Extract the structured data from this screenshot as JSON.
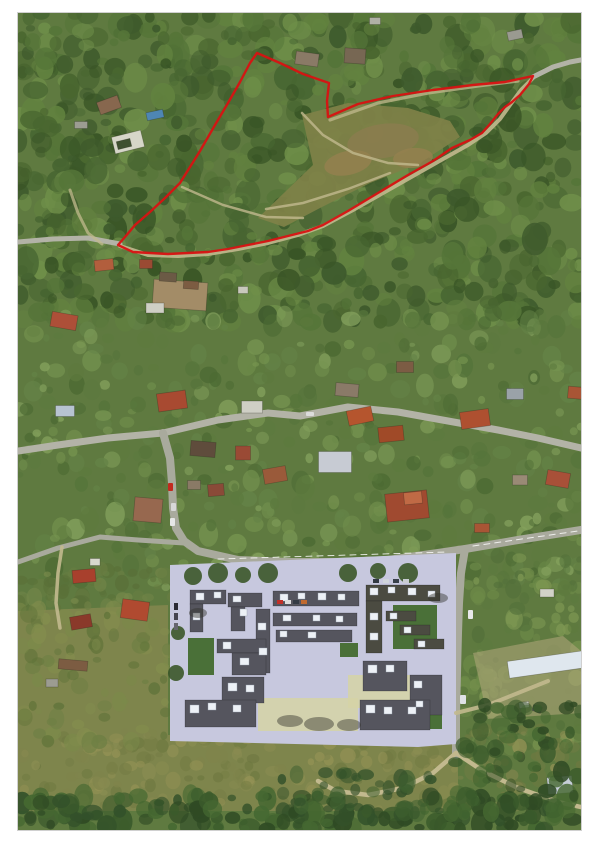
{
  "scene": "aerial-orthophoto-with-parcel-outline",
  "photo": {
    "left": 18,
    "top": 13,
    "width": 563,
    "height": 817
  },
  "colors": {
    "page_bg": "#ffffff",
    "base_green": "#5f7a40",
    "parcel_outline": "#d81212",
    "meadow": "#7f8148",
    "meadow_brown": "#8b7c4f",
    "meadow_brown2": "#94804f",
    "field": "#7e854c",
    "dev_ground": "#c7c8de",
    "dev_building": "#55555e",
    "dev_building_green_roof": "#4b4b41",
    "roofbox": "#edf1f6",
    "lawn": "#4a7038",
    "pale_court": "#d5d3a6",
    "dirt": "#b3a87c",
    "road_main": "#b3b3a7",
    "road_dev": "#a9aa9d",
    "path_tan": "#c2b98e"
  },
  "parcel": {
    "stroke_width": 2.4,
    "points": [
      [
        239,
        40
      ],
      [
        262,
        50
      ],
      [
        285,
        61
      ],
      [
        311,
        70
      ],
      [
        309,
        88
      ],
      [
        310,
        104
      ],
      [
        340,
        91
      ],
      [
        375,
        83
      ],
      [
        415,
        77
      ],
      [
        455,
        72
      ],
      [
        487,
        69
      ],
      [
        515,
        63
      ],
      [
        511,
        71
      ],
      [
        502,
        82
      ],
      [
        494,
        89
      ],
      [
        487,
        94
      ],
      [
        480,
        101
      ],
      [
        472,
        111
      ],
      [
        464,
        120
      ],
      [
        452,
        127
      ],
      [
        434,
        135
      ],
      [
        415,
        148
      ],
      [
        390,
        162
      ],
      [
        360,
        180
      ],
      [
        330,
        198
      ],
      [
        305,
        212
      ],
      [
        290,
        218
      ],
      [
        270,
        223
      ],
      [
        250,
        228
      ],
      [
        230,
        232
      ],
      [
        210,
        236
      ],
      [
        190,
        239
      ],
      [
        170,
        240
      ],
      [
        150,
        241
      ],
      [
        132,
        240
      ],
      [
        115,
        239
      ],
      [
        100,
        232
      ],
      [
        107,
        224
      ],
      [
        117,
        212
      ],
      [
        132,
        199
      ],
      [
        147,
        185
      ],
      [
        162,
        170
      ],
      [
        182,
        138
      ],
      [
        197,
        112
      ],
      [
        210,
        90
      ],
      [
        222,
        69
      ],
      [
        232,
        50
      ]
    ]
  },
  "meadow": {
    "poly": [
      [
        240,
        205
      ],
      [
        268,
        178
      ],
      [
        295,
        152
      ],
      [
        284,
        102
      ],
      [
        330,
        90
      ],
      [
        390,
        95
      ],
      [
        432,
        108
      ],
      [
        442,
        124
      ],
      [
        402,
        150
      ],
      [
        352,
        170
      ],
      [
        302,
        195
      ],
      [
        266,
        214
      ]
    ],
    "brown_spots": [
      [
        365,
        128,
        36,
        17,
        -8
      ],
      [
        330,
        150,
        24,
        12,
        -12
      ],
      [
        395,
        145,
        20,
        10,
        -5
      ]
    ],
    "paths": [
      "M284,100 L305,122 L335,140 L370,150 L400,152",
      "M248,196 L285,190 L330,176 L372,160",
      "M164,174 L205,192 L248,204 L285,205"
    ]
  },
  "fields": [
    [
      [
        0,
        598
      ],
      [
        150,
        592
      ],
      [
        150,
        722
      ],
      [
        440,
        722
      ],
      [
        440,
        798
      ],
      [
        0,
        798
      ]
    ]
  ],
  "dirt_patches": [
    [
      [
        455,
        640
      ],
      [
        545,
        623
      ],
      [
        563,
        638
      ],
      [
        563,
        700
      ],
      [
        470,
        706
      ]
    ]
  ],
  "roads": [
    {
      "d": "M0,438 L40,432 L90,425 L145,420 L200,407 L250,400 L282,403 L330,394 L380,399 L430,408 L480,417 L520,425 L563,435",
      "c": "road_main",
      "w": 7
    },
    {
      "d": "M0,229 L35,226 L70,225 L102,231",
      "c": "road_main",
      "w": 5
    },
    {
      "d": "M145,420 L152,445 L154,470 L155,495 L158,515 L166,528 L180,538 L220,547 L270,549 L320,549 L370,547 L420,540 L447,536 L500,527 L563,517",
      "c": "road_dev",
      "w": 8
    },
    {
      "d": "M447,536 L443,560 L441,590 L440,620 L439,660 L438,700 L438,742",
      "c": "road_dev",
      "w": 8
    },
    {
      "d": "M166,530 L120,527 L82,524 L40,535 L0,549",
      "c": "road_dev",
      "w": 5
    },
    {
      "d": "M44,534 L40,560 L38,590 L42,615",
      "c": "path_tan",
      "w": 3.5,
      "o": 0.9
    },
    {
      "d": "M52,177 L60,200 L70,220 L84,231",
      "c": "path_tan",
      "w": 3,
      "o": 0.75
    },
    {
      "d": "M102,233 L130,242 L160,243 L190,241 L220,236 L250,230 L280,222 L305,213 L335,197 L365,180 L395,163 L425,146 L450,132 L468,120 L482,106 L492,92 L503,77 L515,65",
      "c": "path_tan",
      "w": 4,
      "o": 0.9
    },
    {
      "d": "M312,107 L360,90 L410,80 L460,73 L500,68",
      "c": "path_tan",
      "w": 3.2,
      "o": 0.75
    },
    {
      "d": "M515,64 L535,54 L552,49 L563,47",
      "c": "road_main",
      "w": 5
    },
    {
      "d": "M200,546 L430,539",
      "c": "#ffffff",
      "w": 1,
      "o": 0.8,
      "dash": "6,5"
    },
    {
      "d": "M455,533 L560,518",
      "c": "#ffffff",
      "w": 1,
      "o": 0.8,
      "dash": "6,5"
    }
  ],
  "bottom_paths": [
    {
      "d": "M438,740 L465,758 L500,775 L540,789 L563,794",
      "c": "path_tan",
      "w": 4.5
    },
    {
      "d": "M438,740 L415,760 L385,775 L350,782 L318,778 L300,768",
      "c": "path_tan",
      "w": 4.5
    },
    {
      "d": "M438,700 L470,692 L505,678 L530,668",
      "c": "path_tan",
      "w": 4,
      "o": 0.9
    }
  ],
  "houses": [
    [
      91,
      92,
      22,
      13,
      -20,
      "#87674e"
    ],
    [
      137,
      102,
      17,
      8,
      -12,
      "#4e86b4"
    ],
    [
      110,
      129,
      30,
      17,
      -14,
      "#d6d6c8"
    ],
    [
      106,
      131,
      14,
      8,
      -14,
      "#3f5030"
    ],
    [
      63,
      112,
      13,
      7,
      0,
      "#9c9c92"
    ],
    [
      289,
      46,
      23,
      13,
      8,
      "#8a7a66"
    ],
    [
      337,
      43,
      21,
      15,
      4,
      "#776753"
    ],
    [
      357,
      8,
      11,
      7,
      0,
      "#b0b0a6"
    ],
    [
      497,
      22,
      15,
      9,
      -12,
      "#9a9a90"
    ],
    [
      46,
      308,
      26,
      15,
      10,
      "#ad4f38"
    ],
    [
      86,
      252,
      19,
      11,
      -6,
      "#b25e3d"
    ],
    [
      128,
      251,
      13,
      9,
      0,
      "#9a4a33"
    ],
    [
      162,
      282,
      54,
      28,
      4,
      "#a38c67"
    ],
    [
      150,
      264,
      17,
      9,
      4,
      "#6b5a45"
    ],
    [
      173,
      272,
      15,
      8,
      4,
      "#7c5c42"
    ],
    [
      225,
      277,
      10,
      7,
      0,
      "#c8c8bc"
    ],
    [
      137,
      295,
      18,
      10,
      0,
      "#cfcfc5"
    ],
    [
      47,
      398,
      19,
      11,
      0,
      "#b7c3d1"
    ],
    [
      154,
      388,
      29,
      18,
      -8,
      "#a84a31"
    ],
    [
      234,
      394,
      21,
      12,
      0,
      "#cfcfc5"
    ],
    [
      342,
      403,
      25,
      15,
      -12,
      "#b5552e"
    ],
    [
      373,
      421,
      25,
      15,
      -6,
      "#a04a28"
    ],
    [
      457,
      406,
      29,
      17,
      -8,
      "#ae5030"
    ],
    [
      329,
      377,
      23,
      13,
      5,
      "#8a7a68"
    ],
    [
      387,
      354,
      17,
      11,
      0,
      "#7c5c44"
    ],
    [
      560,
      380,
      20,
      12,
      5,
      "#a85535"
    ],
    [
      497,
      381,
      17,
      11,
      0,
      "#9aa2a8"
    ],
    [
      185,
      436,
      25,
      15,
      5,
      "#5f4c3c"
    ],
    [
      225,
      440,
      15,
      14,
      0,
      "#9a4a35"
    ],
    [
      198,
      477,
      16,
      12,
      -5,
      "#8a4a38"
    ],
    [
      130,
      497,
      28,
      24,
      5,
      "#97684f"
    ],
    [
      257,
      462,
      23,
      15,
      -10,
      "#9a5a3a"
    ],
    [
      317,
      449,
      33,
      21,
      0,
      "#c7cbd3"
    ],
    [
      389,
      493,
      42,
      28,
      -6,
      "#a04a30"
    ],
    [
      395,
      485,
      18,
      12,
      -6,
      "#c06a45"
    ],
    [
      540,
      466,
      23,
      15,
      10,
      "#a85038"
    ],
    [
      176,
      472,
      13,
      9,
      0,
      "#8a7a66"
    ],
    [
      502,
      467,
      15,
      10,
      0,
      "#9a8a76"
    ],
    [
      464,
      515,
      15,
      9,
      0,
      "#a85535"
    ],
    [
      77,
      549,
      10,
      7,
      0,
      "#d8d8ce"
    ],
    [
      66,
      563,
      23,
      13,
      -5,
      "#a8402d"
    ],
    [
      117,
      597,
      27,
      19,
      8,
      "#b04a30"
    ],
    [
      63,
      609,
      21,
      13,
      -10,
      "#8a392a"
    ],
    [
      55,
      652,
      29,
      10,
      5,
      "#7c5c42"
    ],
    [
      34,
      670,
      12,
      8,
      0,
      "#9c9c92"
    ],
    [
      532,
      651,
      84,
      17,
      -8,
      "#dfe7ee"
    ],
    [
      529,
      580,
      14,
      8,
      0,
      "#d2d2c8"
    ],
    [
      542,
      772,
      25,
      17,
      -5,
      "#c6ced8"
    ],
    [
      506,
      692,
      10,
      6,
      -8,
      "#e0e0d8"
    ],
    [
      519,
      696,
      9,
      6,
      20,
      "#55555c"
    ]
  ],
  "development": {
    "ground": [
      [
        152,
        552
      ],
      [
        438,
        540
      ],
      [
        438,
        731
      ],
      [
        400,
        734
      ],
      [
        152,
        728
      ]
    ],
    "pale": [
      [
        240,
        685,
        100,
        33
      ],
      [
        330,
        662,
        72,
        33
      ]
    ],
    "lawns": [
      [
        170,
        625,
        26,
        37
      ],
      [
        375,
        592,
        44,
        44
      ],
      [
        398,
        702,
        26,
        14
      ],
      [
        322,
        630,
        18,
        14
      ]
    ],
    "buildings": [
      [
        172,
        577,
        36,
        14
      ],
      [
        172,
        591,
        13,
        28
      ],
      [
        210,
        580,
        34,
        14
      ],
      [
        213,
        594,
        14,
        24
      ],
      [
        255,
        578,
        86,
        15
      ],
      [
        255,
        600,
        84,
        13
      ],
      [
        258,
        617,
        76,
        12
      ],
      [
        238,
        596,
        14,
        64
      ],
      [
        199,
        626,
        49,
        14
      ],
      [
        214,
        640,
        34,
        22
      ],
      [
        204,
        664,
        42,
        26
      ],
      [
        167,
        687,
        71,
        27
      ],
      [
        348,
        572,
        74,
        16,
        "g"
      ],
      [
        348,
        588,
        16,
        52,
        "g"
      ],
      [
        368,
        598,
        30,
        10,
        "g"
      ],
      [
        382,
        612,
        30,
        10,
        "g"
      ],
      [
        396,
        626,
        30,
        10,
        "g"
      ],
      [
        345,
        648,
        44,
        30
      ],
      [
        392,
        662,
        32,
        40
      ],
      [
        342,
        687,
        70,
        30
      ]
    ],
    "roofboxes": [
      [
        178,
        580,
        8,
        7
      ],
      [
        196,
        579,
        7,
        6
      ],
      [
        175,
        600,
        7,
        7
      ],
      [
        215,
        583,
        8,
        6
      ],
      [
        222,
        596,
        7,
        7
      ],
      [
        262,
        581,
        8,
        7
      ],
      [
        280,
        580,
        7,
        6
      ],
      [
        300,
        580,
        8,
        7
      ],
      [
        320,
        581,
        7,
        6
      ],
      [
        265,
        602,
        8,
        6
      ],
      [
        295,
        602,
        7,
        6
      ],
      [
        318,
        603,
        7,
        6
      ],
      [
        262,
        618,
        7,
        6
      ],
      [
        290,
        619,
        8,
        6
      ],
      [
        240,
        610,
        8,
        7
      ],
      [
        241,
        635,
        8,
        7
      ],
      [
        205,
        629,
        8,
        7
      ],
      [
        222,
        645,
        9,
        7
      ],
      [
        210,
        670,
        9,
        8
      ],
      [
        228,
        672,
        8,
        7
      ],
      [
        172,
        692,
        9,
        8
      ],
      [
        190,
        690,
        8,
        7
      ],
      [
        215,
        692,
        8,
        7
      ],
      [
        352,
        575,
        8,
        7
      ],
      [
        370,
        574,
        7,
        6
      ],
      [
        390,
        575,
        8,
        7
      ],
      [
        410,
        578,
        7,
        6
      ],
      [
        352,
        600,
        8,
        7
      ],
      [
        352,
        620,
        8,
        7
      ],
      [
        372,
        600,
        7,
        6
      ],
      [
        386,
        614,
        7,
        6
      ],
      [
        400,
        628,
        7,
        6
      ],
      [
        350,
        652,
        9,
        8
      ],
      [
        368,
        652,
        8,
        7
      ],
      [
        396,
        668,
        8,
        7
      ],
      [
        398,
        688,
        7,
        6
      ],
      [
        348,
        692,
        9,
        8
      ],
      [
        366,
        694,
        8,
        7
      ],
      [
        390,
        694,
        8,
        7
      ]
    ],
    "trees": [
      [
        175,
        563,
        9
      ],
      [
        200,
        560,
        10
      ],
      [
        225,
        562,
        8
      ],
      [
        250,
        560,
        10
      ],
      [
        330,
        560,
        9
      ],
      [
        360,
        558,
        8
      ],
      [
        390,
        560,
        10
      ],
      [
        160,
        620,
        7
      ],
      [
        158,
        660,
        8
      ]
    ],
    "shadows": [
      [
        272,
        708,
        13,
        6
      ],
      [
        301,
        711,
        15,
        7
      ],
      [
        331,
        712,
        12,
        6
      ],
      [
        180,
        600,
        9,
        5
      ],
      [
        420,
        585,
        10,
        5
      ]
    ],
    "cars": [
      [
        259,
        587,
        6,
        4,
        "#c23028"
      ],
      [
        267,
        587,
        6,
        4,
        "#dddddd"
      ],
      [
        275,
        587,
        6,
        4,
        "#333a44"
      ],
      [
        283,
        587,
        6,
        4,
        "#c06a30"
      ],
      [
        156,
        590,
        4,
        7,
        "#2a2a33"
      ],
      [
        156,
        600,
        4,
        7,
        "#44444e"
      ],
      [
        156,
        610,
        4,
        7,
        "#66666e"
      ],
      [
        355,
        566,
        6,
        4,
        "#333a44"
      ],
      [
        365,
        566,
        6,
        4,
        "#cfd4da"
      ],
      [
        375,
        566,
        6,
        4,
        "#39414b"
      ],
      [
        385,
        566,
        6,
        4,
        "#c8ccd2"
      ]
    ]
  },
  "road_cars": [
    [
      150,
      470,
      5,
      8,
      "#c22a1e"
    ],
    [
      153,
      490,
      5,
      8,
      "#d8d8d8"
    ],
    [
      152,
      505,
      5,
      8,
      "#e6e6e6"
    ],
    [
      450,
      597,
      5,
      9,
      "#e8e8ea"
    ],
    [
      442,
      682,
      6,
      9,
      "#dfe2e6"
    ],
    [
      288,
      399,
      8,
      4,
      "#dcdcdc"
    ]
  ],
  "texture": {
    "seed": 7,
    "forest": [
      {
        "x0": 0,
        "x1": 563,
        "y0": 0,
        "y1": 310,
        "n": 850,
        "rmin": 4,
        "rmax": 13,
        "omin": 0.5,
        "omax": 0.95,
        "palette": [
          "#3e5a2c",
          "#49662f",
          "#557538",
          "#62823f",
          "#6f8f49",
          "#476531",
          "#395526"
        ]
      },
      {
        "x0": 0,
        "x1": 563,
        "y0": 300,
        "y1": 575,
        "n": 480,
        "rmin": 3,
        "rmax": 10,
        "omin": 0.45,
        "omax": 0.85,
        "palette": [
          "#55743a",
          "#648347",
          "#75934f",
          "#4c6a33",
          "#83a05c",
          "#5d7a3e"
        ]
      },
      {
        "x0": 440,
        "x1": 563,
        "y0": 540,
        "y1": 735,
        "n": 140,
        "rmin": 3,
        "rmax": 9,
        "omin": 0.45,
        "omax": 0.8,
        "palette": [
          "#5d7a3e",
          "#6d8a48",
          "#7d9752",
          "#53703a"
        ]
      },
      {
        "x0": 0,
        "x1": 160,
        "y0": 555,
        "y1": 600,
        "n": 60,
        "rmin": 3,
        "rmax": 8,
        "omin": 0.4,
        "omax": 0.8,
        "palette": [
          "#687d42",
          "#76884a",
          "#5a7038"
        ]
      }
    ],
    "field": [
      {
        "x0": 0,
        "x1": 563,
        "y0": 715,
        "y1": 795,
        "n": 260,
        "rmin": 3,
        "rmax": 8,
        "omin": 0.4,
        "omax": 0.75,
        "palette": [
          "#7f844c",
          "#8b8d52",
          "#747c44",
          "#969356",
          "#6d7840"
        ]
      },
      {
        "x0": 0,
        "x1": 150,
        "y0": 592,
        "y1": 730,
        "n": 90,
        "rmin": 3,
        "rmax": 9,
        "omin": 0.4,
        "omax": 0.75,
        "palette": [
          "#6d7f44",
          "#7b8a4a",
          "#5f7339",
          "#848e4e"
        ]
      }
    ],
    "bushes": [
      {
        "x0": 0,
        "x1": 563,
        "y0": 782,
        "y1": 817,
        "n": 170,
        "rmin": 4,
        "rmax": 11,
        "omin": 0.6,
        "omax": 0.95,
        "palette": [
          "#2f4a24",
          "#3a5a2b",
          "#456831",
          "#33512a"
        ]
      },
      {
        "x0": 430,
        "x1": 563,
        "y0": 690,
        "y1": 800,
        "n": 70,
        "rmin": 4,
        "rmax": 10,
        "omin": 0.5,
        "omax": 0.9,
        "palette": [
          "#2f4a24",
          "#3a5a2b",
          "#456831"
        ]
      },
      {
        "x0": 260,
        "x1": 420,
        "y0": 758,
        "y1": 800,
        "n": 40,
        "rmin": 4,
        "rmax": 9,
        "omin": 0.5,
        "omax": 0.85,
        "palette": [
          "#33512a",
          "#3f6030"
        ]
      }
    ]
  }
}
